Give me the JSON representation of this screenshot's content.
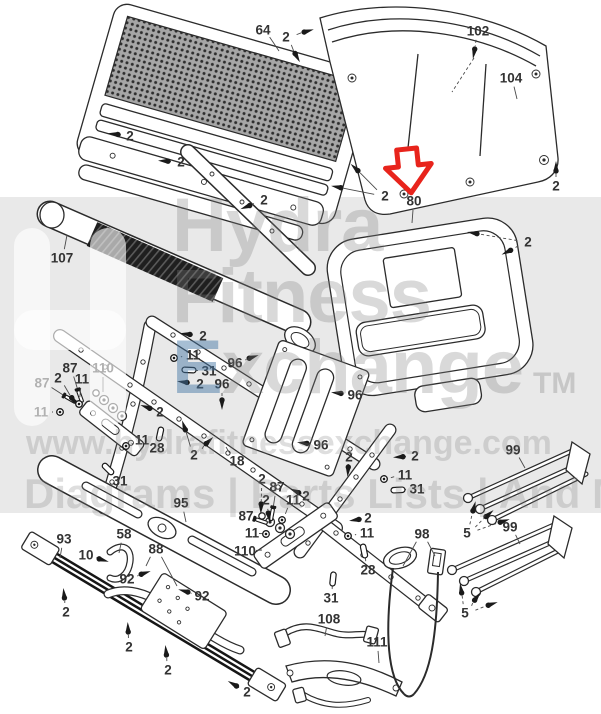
{
  "watermark": {
    "brand_line1": "Hydra",
    "brand_line2": "Fitness",
    "exchange_initial": "E",
    "exchange_rest": "xchange",
    "trademark": "TM",
    "website": "www.hydrafitnessexchange.com",
    "tagline": "Diagrams | Parts Lists | And More",
    "band_color": "#e9e9e9"
  },
  "diagram": {
    "arrow_color": "#e8241c",
    "line_color": "#2b2b2b",
    "label_color": "#333333",
    "labels": [
      {
        "t": "64",
        "x": 263,
        "y": 30,
        "g": "none",
        "ts": [
          [
            279,
            51
          ]
        ]
      },
      {
        "t": "2",
        "x": 286,
        "y": 37,
        "g": "screw",
        "ts": [
          [
            308,
            31
          ],
          [
            297,
            57
          ]
        ]
      },
      {
        "t": "102",
        "x": 478,
        "y": 31,
        "g": "screw",
        "ts": [
          [
            474,
            53
          ]
        ],
        "d": 1
      },
      {
        "t": "104",
        "x": 511,
        "y": 78,
        "g": "none",
        "ts": [
          [
            517,
            99
          ]
        ]
      },
      {
        "t": "2",
        "x": 130,
        "y": 136,
        "g": "screw",
        "ts": [
          [
            114,
            134
          ]
        ]
      },
      {
        "t": "2",
        "x": 181,
        "y": 162,
        "g": "screw",
        "ts": [
          [
            164,
            161
          ]
        ]
      },
      {
        "t": "2",
        "x": 264,
        "y": 200,
        "g": "screw",
        "ts": [
          [
            246,
            207
          ]
        ]
      },
      {
        "t": "2",
        "x": 385,
        "y": 196,
        "g": "screw",
        "ts": [
          [
            355,
            168
          ],
          [
            337,
            187
          ]
        ]
      },
      {
        "t": "2",
        "x": 556,
        "y": 186,
        "g": "screw",
        "ts": [
          [
            556,
            167
          ]
        ]
      },
      {
        "t": "80",
        "x": 414,
        "y": 201,
        "g": "none",
        "ts": [
          [
            412,
            223
          ]
        ]
      },
      {
        "t": "2",
        "x": 528,
        "y": 242,
        "g": "screw",
        "ts": [
          [
            473,
            233
          ],
          [
            507,
            252
          ]
        ],
        "d": 1
      },
      {
        "t": "107",
        "x": 62,
        "y": 258,
        "g": "none",
        "ts": [
          [
            67,
            235
          ]
        ]
      },
      {
        "t": "2",
        "x": 203,
        "y": 336,
        "g": "screw",
        "ts": [
          [
            186,
            334
          ]
        ]
      },
      {
        "t": "11",
        "x": 193,
        "y": 355,
        "g": "nut",
        "ts": [
          [
            174,
            358
          ]
        ]
      },
      {
        "t": "31",
        "x": 209,
        "y": 371,
        "g": "pin",
        "ts": [
          [
            189,
            370
          ]
        ]
      },
      {
        "t": "2",
        "x": 200,
        "y": 384,
        "g": "screw",
        "ts": [
          [
            183,
            382
          ]
        ]
      },
      {
        "t": "96",
        "x": 235,
        "y": 363,
        "g": "screw",
        "ts": [
          [
            253,
            357
          ]
        ]
      },
      {
        "t": "96",
        "x": 222,
        "y": 384,
        "g": "screw",
        "ts": [
          [
            222,
            404
          ]
        ],
        "d": 1
      },
      {
        "t": "96",
        "x": 355,
        "y": 395,
        "g": "screw",
        "ts": [
          [
            337,
            393
          ]
        ]
      },
      {
        "t": "87",
        "x": 70,
        "y": 368,
        "g": "bolt",
        "ts": [
          [
            80,
            396
          ]
        ]
      },
      {
        "t": "110",
        "x": 103,
        "y": 368,
        "g": "none",
        "ts": [
          [
            103,
            392
          ]
        ]
      },
      {
        "t": "87",
        "x": 42,
        "y": 383,
        "g": "bolt",
        "ts": [
          [
            70,
            399
          ]
        ]
      },
      {
        "t": "2",
        "x": 58,
        "y": 378,
        "g": "screw",
        "ts": [
          [
            74,
            401
          ]
        ]
      },
      {
        "t": "11",
        "x": 82,
        "y": 379,
        "g": "nut",
        "ts": [
          [
            79,
            404
          ]
        ]
      },
      {
        "t": "11",
        "x": 41,
        "y": 412,
        "g": "nut",
        "ts": [
          [
            60,
            412
          ]
        ]
      },
      {
        "t": "2",
        "x": 160,
        "y": 412,
        "g": "screw",
        "ts": [
          [
            146,
            407
          ]
        ]
      },
      {
        "t": "11",
        "x": 142,
        "y": 440,
        "g": "nut",
        "ts": [
          [
            126,
            446
          ]
        ]
      },
      {
        "t": "28",
        "x": 157,
        "y": 448,
        "g": "pin",
        "ts": [
          [
            160,
            434
          ]
        ]
      },
      {
        "t": "31",
        "x": 120,
        "y": 481,
        "g": "pin",
        "ts": [
          [
            108,
            469
          ]
        ]
      },
      {
        "t": "2",
        "x": 194,
        "y": 455,
        "g": "screw",
        "ts": [
          [
            184,
            426
          ],
          [
            209,
            441
          ]
        ]
      },
      {
        "t": "18",
        "x": 237,
        "y": 461,
        "g": "none",
        "ts": [
          [
            226,
            447
          ]
        ]
      },
      {
        "t": "96",
        "x": 321,
        "y": 445,
        "g": "screw",
        "ts": [
          [
            303,
            443
          ]
        ]
      },
      {
        "t": "2",
        "x": 349,
        "y": 457,
        "g": "screw",
        "ts": [
          [
            348,
            471
          ]
        ],
        "d": 1
      },
      {
        "t": "2",
        "x": 415,
        "y": 456,
        "g": "screw",
        "ts": [
          [
            399,
            457
          ]
        ]
      },
      {
        "t": "11",
        "x": 405,
        "y": 475,
        "g": "nut",
        "ts": [
          [
            384,
            479
          ]
        ]
      },
      {
        "t": "31",
        "x": 417,
        "y": 489,
        "g": "pin",
        "ts": [
          [
            398,
            490
          ]
        ]
      },
      {
        "t": "95",
        "x": 181,
        "y": 503,
        "g": "none",
        "ts": [
          [
            186,
            522
          ]
        ]
      },
      {
        "t": "2",
        "x": 262,
        "y": 479,
        "g": "screw",
        "ts": [
          [
            261,
            508
          ]
        ],
        "d": 1
      },
      {
        "t": "87",
        "x": 277,
        "y": 487,
        "g": "bolt",
        "ts": [
          [
            272,
            514
          ]
        ]
      },
      {
        "t": "2",
        "x": 266,
        "y": 500,
        "g": "screw",
        "ts": [
          [
            269,
            517
          ]
        ]
      },
      {
        "t": "11",
        "x": 293,
        "y": 500,
        "g": "nut",
        "ts": [
          [
            282,
            520
          ]
        ]
      },
      {
        "t": "2",
        "x": 306,
        "y": 496,
        "g": "screw",
        "ts": [
          [
            295,
            491
          ]
        ]
      },
      {
        "t": "87",
        "x": 246,
        "y": 516,
        "g": "bolt",
        "ts": [
          [
            261,
            521
          ]
        ]
      },
      {
        "t": "11",
        "x": 252,
        "y": 533,
        "g": "nut",
        "ts": [
          [
            266,
            534
          ]
        ]
      },
      {
        "t": "110",
        "x": 245,
        "y": 551,
        "g": "none",
        "ts": [
          [
            262,
            550
          ]
        ]
      },
      {
        "t": "2",
        "x": 368,
        "y": 518,
        "g": "screw",
        "ts": [
          [
            355,
            520
          ]
        ]
      },
      {
        "t": "11",
        "x": 367,
        "y": 533,
        "g": "nut",
        "ts": [
          [
            348,
            536
          ]
        ]
      },
      {
        "t": "28",
        "x": 368,
        "y": 570,
        "g": "pin",
        "ts": [
          [
            364,
            551
          ]
        ]
      },
      {
        "t": "31",
        "x": 331,
        "y": 598,
        "g": "pin",
        "ts": [
          [
            333,
            579
          ]
        ]
      },
      {
        "t": "93",
        "x": 64,
        "y": 539,
        "g": "none",
        "ts": [
          [
            60,
            558
          ]
        ]
      },
      {
        "t": "10",
        "x": 86,
        "y": 555,
        "g": "screw",
        "ts": [
          [
            103,
            560
          ]
        ]
      },
      {
        "t": "58",
        "x": 124,
        "y": 534,
        "g": "none",
        "ts": [
          [
            119,
            553
          ]
        ]
      },
      {
        "t": "88",
        "x": 156,
        "y": 549,
        "g": "none",
        "ts": [
          [
            146,
            566
          ],
          [
            177,
            586
          ]
        ]
      },
      {
        "t": "92",
        "x": 127,
        "y": 579,
        "g": "screw",
        "ts": [
          [
            145,
            573
          ]
        ]
      },
      {
        "t": "92",
        "x": 202,
        "y": 596,
        "g": "screw",
        "ts": [
          [
            184,
            591
          ]
        ]
      },
      {
        "t": "2",
        "x": 66,
        "y": 612,
        "g": "screw",
        "ts": [
          [
            64,
            594
          ]
        ],
        "d": 1
      },
      {
        "t": "2",
        "x": 129,
        "y": 647,
        "g": "screw",
        "ts": [
          [
            128,
            628
          ]
        ],
        "d": 1
      },
      {
        "t": "2",
        "x": 168,
        "y": 670,
        "g": "screw",
        "ts": [
          [
            166,
            651
          ]
        ],
        "d": 1
      },
      {
        "t": "2",
        "x": 247,
        "y": 692,
        "g": "screw",
        "ts": [
          [
            233,
            684
          ]
        ],
        "d": 1
      },
      {
        "t": "108",
        "x": 329,
        "y": 619,
        "g": "none",
        "ts": [
          [
            325,
            636
          ]
        ]
      },
      {
        "t": "111",
        "x": 377,
        "y": 642,
        "g": "none",
        "ts": [
          [
            379,
            663
          ]
        ]
      },
      {
        "t": "98",
        "x": 422,
        "y": 534,
        "g": "none",
        "ts": [
          [
            403,
            566
          ],
          [
            435,
            556
          ]
        ]
      },
      {
        "t": "99",
        "x": 513,
        "y": 450,
        "g": "none",
        "ts": [
          [
            525,
            468
          ]
        ]
      },
      {
        "t": "5",
        "x": 467,
        "y": 533,
        "g": "screw",
        "ts": [
          [
            474,
            507
          ],
          [
            489,
            514
          ],
          [
            504,
            521
          ]
        ],
        "d": 1
      },
      {
        "t": "99",
        "x": 510,
        "y": 527,
        "g": "none",
        "ts": [
          [
            520,
            544
          ]
        ]
      },
      {
        "t": "5",
        "x": 465,
        "y": 613,
        "g": "screw",
        "ts": [
          [
            461,
            589
          ],
          [
            477,
            597
          ],
          [
            492,
            604
          ]
        ],
        "d": 1
      }
    ]
  }
}
